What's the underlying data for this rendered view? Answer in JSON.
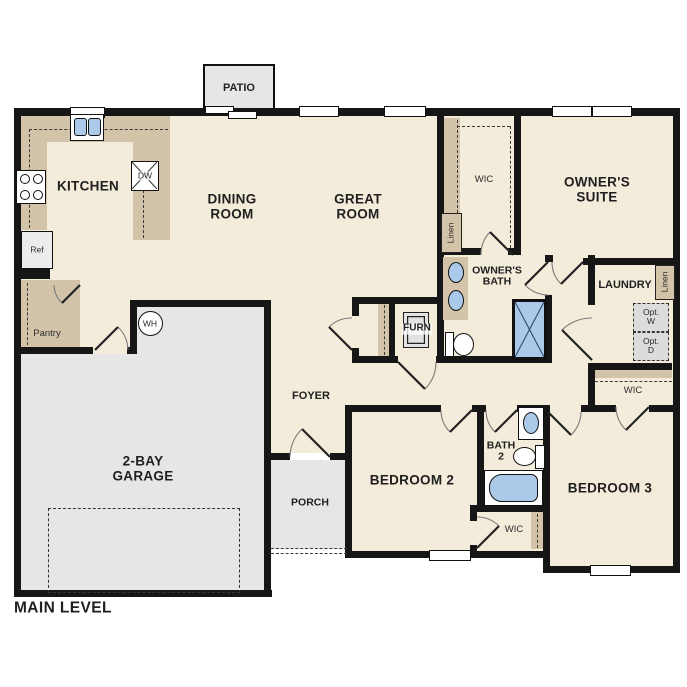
{
  "plan_title": "MAIN LEVEL",
  "colors": {
    "floor": "#f3ecdb",
    "counter": "#d2c3a9",
    "concrete": "#e6e6e4",
    "fixture_blue": "#abc9e9",
    "wall": "#161616",
    "label": "#1f1f1f"
  },
  "rooms": {
    "kitchen": "KITCHEN",
    "dining_line1": "DINING",
    "dining_line2": "ROOM",
    "great_line1": "GREAT",
    "great_line2": "ROOM",
    "owners_suite_line1": "OWNER'S",
    "owners_suite_line2": "SUITE",
    "owners_bath_line1": "OWNER'S",
    "owners_bath_line2": "BATH",
    "laundry": "LAUNDRY",
    "foyer": "FOYER",
    "porch": "PORCH",
    "patio": "PATIO",
    "garage_line1": "2-BAY",
    "garage_line2": "GARAGE",
    "bedroom2": "BEDROOM 2",
    "bedroom3": "BEDROOM 3",
    "bath2_line1": "BATH",
    "bath2_line2": "2",
    "wic": "WIC",
    "pantry": "Pantry"
  },
  "fixtures": {
    "dishwasher": "DW",
    "refrigerator": "Ref",
    "water_heater": "WH",
    "furnace": "FURN",
    "linen": "Linen",
    "opt_washer_line1": "Opt.",
    "opt_washer_line2": "W",
    "opt_dryer_line1": "Opt.",
    "opt_dryer_line2": "D"
  }
}
